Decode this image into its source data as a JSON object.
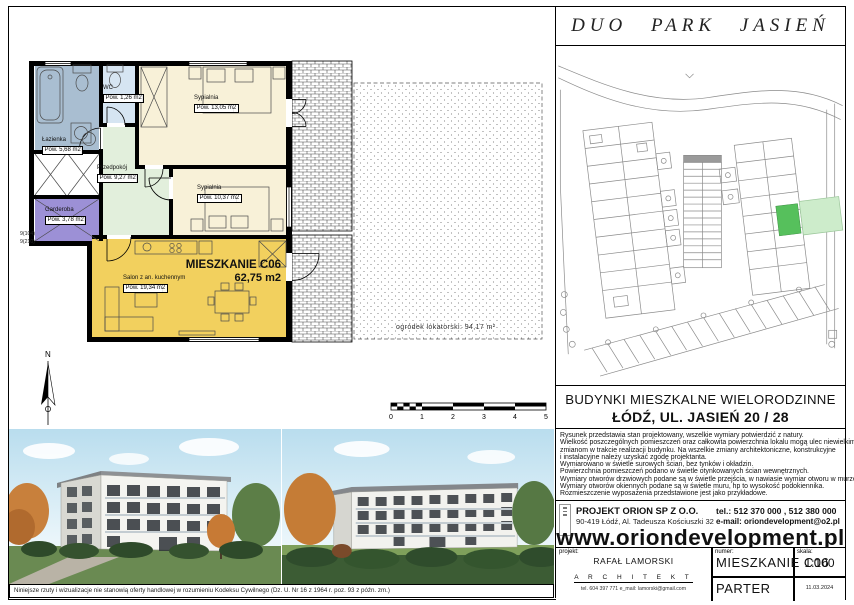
{
  "header": {
    "title": "DUO PARK JASIEŃ"
  },
  "plan": {
    "apartment_name": "MIESZKANIE C06",
    "apartment_area": "62,75 m2",
    "garden_label": "ogródek lokatorski:  94,17 m²",
    "compass_label": "N",
    "dim_labels": [
      "9(104)",
      "9(210)"
    ],
    "scale_ticks": [
      "0",
      "1",
      "2",
      "3",
      "4",
      "5"
    ],
    "rooms": [
      {
        "name": "Sypialnia",
        "id": "Pom. C06.03",
        "area": "Pow. 13,05 m2"
      },
      {
        "name": "Sypialnia",
        "id": "Pom. C06.02",
        "area": "Pow. 10,37 m2"
      },
      {
        "name": "Łazienka",
        "id": "Pom. C06.04",
        "area": "Pow. 5,68 m2"
      },
      {
        "name": "WC",
        "id": "Pom. C06.05",
        "area": "Pow. 1,26 m2"
      },
      {
        "name": "Przedpokój",
        "id": "Pom. C06.07",
        "area": "Pow. 9,27 m2"
      },
      {
        "name": "Garderoba",
        "id": "Pom. C06.06",
        "area": "Pow. 3,78 m2"
      },
      {
        "name": "Salon z an. kuchennym",
        "id": "Pom. C06.01",
        "area": "Pow. 19,34 m2"
      }
    ]
  },
  "project": {
    "line1": "BUDYNKI MIESZKALNE WIELORODZINNE",
    "line2": "ŁÓDŹ, UL. JASIEŃ 20 / 28"
  },
  "notes": {
    "lines": [
      "Rysunek przedstawia stan projektowany, wszelkie wymiary potwierdzić z natury.",
      "Wielkość poszczególnych pomieszczeń oraz całkowita powierzchnia lokalu mogą ulec niewielkim",
      "zmianom w trakcie realizacji budynku. Na wszelkie zmiany architektoniczne, konstrukcyjne",
      "i instalacyjne należy uzyskać zgodę projektanta.",
      "Wymiarowano w świetle surowych ścian, bez tynków i okładzin.",
      "Powierzchnia pomieszczeń podano w świetle otynkowanych ścian wewnętrznych.",
      "Wymiary otworów drzwiowych podane są w świetle przejścia, w nawiasie wymiar otworu w murze.",
      "Wymiary otworów okiennych podane są w świetle muru, hp to wysokość podokiennika.",
      "Rozmieszczenie wyposażenia przedstawione jest jako przykładowe."
    ]
  },
  "company": {
    "name": "PROJEKT ORION SP Z O.O.",
    "address": "90-419 Łódź, Al. Tadeusza Kościuszki 32",
    "phone": "tel.: 512 370 000 , 512 380 000",
    "email": "e-mail: oriondevelopment@o2.pl",
    "website": "www.oriondevelopment.pl"
  },
  "titleblock": {
    "label_project": "projekt:",
    "label_number": "numer:",
    "label_scale": "skala:",
    "architect_name": "RAFAŁ LAMORSKI",
    "architect_title": "A R C H I T E K T",
    "architect_contact": "tel. 604 397 771    e_mail: lamorski@gmail.com",
    "number": "MIESZKANIE  C06",
    "scale": "1:100",
    "floor": "PARTER",
    "date": "11.03.2024"
  },
  "footer": {
    "disclaimer": "Niniejsze rzuty i wizualizacje nie stanowią oferty handlowej w rozumieniu Kodeksu Cywilnego (Dz. U. Nr 16 z 1964 r. poz. 93 z późn. zm.)"
  },
  "colors": {
    "bathroom": "#a9bed1",
    "wc": "#d6e5f2",
    "bedroom": "#f8f1d8",
    "hall": "#e2efdc",
    "wardrobe": "#9c90d6",
    "living": "#f2d05e",
    "site_unit": "#56c05c",
    "site_garden": "#cdeccb"
  }
}
